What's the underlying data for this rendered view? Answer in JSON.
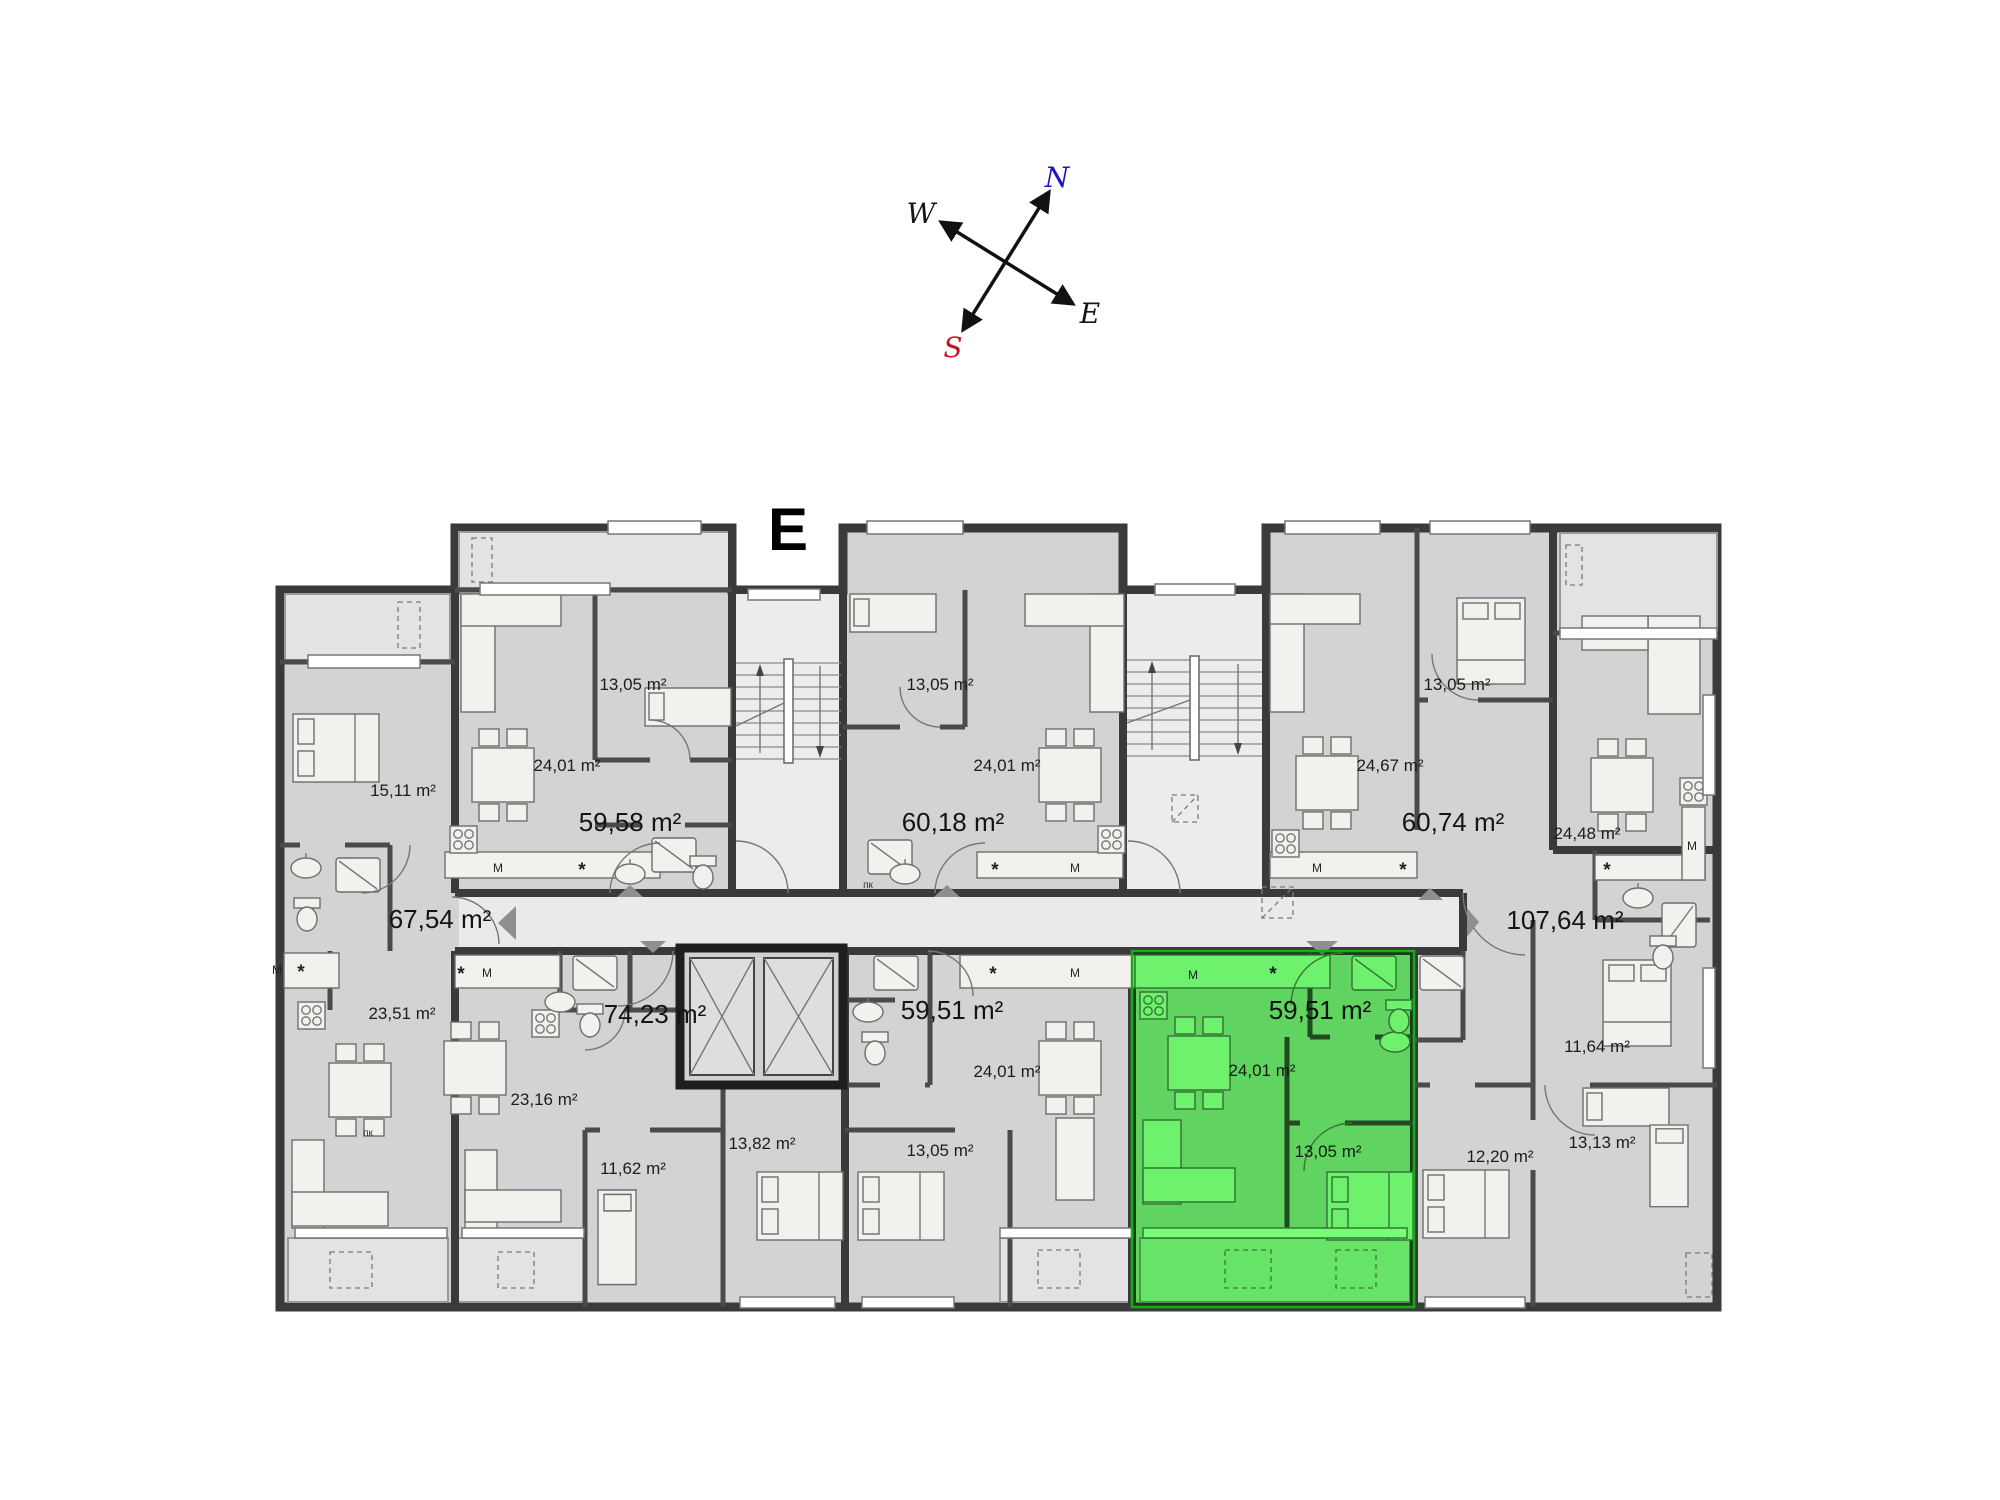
{
  "page": {
    "background": "#ffffff"
  },
  "compass": {
    "arrow_color": "#111111",
    "letters": [
      {
        "text": "N",
        "x": 1057,
        "y": 187,
        "color": "#1a16c4"
      },
      {
        "text": "W",
        "x": 921,
        "y": 223,
        "color": "#161616"
      },
      {
        "text": "E",
        "x": 1090,
        "y": 323,
        "color": "#161616"
      },
      {
        "text": "S",
        "x": 953,
        "y": 357,
        "color": "#c41420"
      }
    ]
  },
  "plan": {
    "block_label": "E",
    "colors": {
      "floor": "#d3d3d3",
      "wall": "#3a3a3a",
      "corridor": "#eaeaea",
      "terrace": "#e3e3e3",
      "furniture": "#f2f1ee",
      "highlight": "#74ff74",
      "highlight_border": "#13ae13",
      "label": "#1c1c1c",
      "triangle": "#8f8f8f"
    },
    "highlight_unit": {
      "label": "59,51 m²",
      "x": 1132,
      "y": 951,
      "width": 282,
      "height": 356
    },
    "area_labels": [
      {
        "text": "13,05 m²",
        "x": 633,
        "y": 690,
        "size": "sm"
      },
      {
        "text": "24,01 m²",
        "x": 567,
        "y": 771,
        "size": "sm"
      },
      {
        "text": "15,11 m²",
        "x": 403,
        "y": 796,
        "size": "sm"
      },
      {
        "text": "59,58 m²",
        "x": 630,
        "y": 831,
        "size": "lg"
      },
      {
        "text": "13,05 m²",
        "x": 940,
        "y": 690,
        "size": "sm"
      },
      {
        "text": "24,01 m²",
        "x": 1007,
        "y": 771,
        "size": "sm"
      },
      {
        "text": "60,18 m²",
        "x": 953,
        "y": 831,
        "size": "lg"
      },
      {
        "text": "13,05 m²",
        "x": 1457,
        "y": 690,
        "size": "sm"
      },
      {
        "text": "24,67 m²",
        "x": 1390,
        "y": 771,
        "size": "sm"
      },
      {
        "text": "60,74 m²",
        "x": 1453,
        "y": 831,
        "size": "lg"
      },
      {
        "text": "24,48 m²",
        "x": 1587,
        "y": 839,
        "size": "sm"
      },
      {
        "text": "67,54 m²",
        "x": 440,
        "y": 928,
        "size": "lg"
      },
      {
        "text": "107,64 m²",
        "x": 1565,
        "y": 929,
        "size": "lg"
      },
      {
        "text": "23,51 m²",
        "x": 402,
        "y": 1019,
        "size": "sm"
      },
      {
        "text": "74,23 m²",
        "x": 655,
        "y": 1023,
        "size": "lg"
      },
      {
        "text": "59,51 m²",
        "x": 952,
        "y": 1019,
        "size": "lg"
      },
      {
        "text": "59,51 m²",
        "x": 1320,
        "y": 1019,
        "size": "lg"
      },
      {
        "text": "23,16 m²",
        "x": 544,
        "y": 1105,
        "size": "sm"
      },
      {
        "text": "24,01 m²",
        "x": 1007,
        "y": 1077,
        "size": "sm"
      },
      {
        "text": "24,01 m²",
        "x": 1262,
        "y": 1076,
        "size": "sm"
      },
      {
        "text": "11,62 m²",
        "x": 633,
        "y": 1174,
        "size": "sm"
      },
      {
        "text": "13,82 m²",
        "x": 762,
        "y": 1149,
        "size": "sm"
      },
      {
        "text": "13,05 m²",
        "x": 940,
        "y": 1156,
        "size": "sm"
      },
      {
        "text": "13,05 m²",
        "x": 1328,
        "y": 1157,
        "size": "sm"
      },
      {
        "text": "12,20 m²",
        "x": 1500,
        "y": 1162,
        "size": "sm"
      },
      {
        "text": "13,13 m²",
        "x": 1602,
        "y": 1148,
        "size": "sm"
      },
      {
        "text": "11,64 m²",
        "x": 1597,
        "y": 1052,
        "size": "sm"
      }
    ],
    "kitchen_marks": [
      {
        "text": "M",
        "x": 498,
        "y": 872,
        "kind": "m"
      },
      {
        "text": "*",
        "x": 582,
        "y": 876,
        "kind": "star"
      },
      {
        "text": "*",
        "x": 995,
        "y": 876,
        "kind": "star"
      },
      {
        "text": "M",
        "x": 1075,
        "y": 872,
        "kind": "m"
      },
      {
        "text": "M",
        "x": 1317,
        "y": 872,
        "kind": "m"
      },
      {
        "text": "*",
        "x": 1403,
        "y": 876,
        "kind": "star"
      },
      {
        "text": "*",
        "x": 1607,
        "y": 876,
        "kind": "star"
      },
      {
        "text": "M",
        "x": 1692,
        "y": 850,
        "kind": "m"
      },
      {
        "text": "M",
        "x": 277,
        "y": 974,
        "kind": "m"
      },
      {
        "text": "*",
        "x": 301,
        "y": 978,
        "kind": "star"
      },
      {
        "text": "*",
        "x": 461,
        "y": 980,
        "kind": "star"
      },
      {
        "text": "M",
        "x": 487,
        "y": 977,
        "kind": "m"
      },
      {
        "text": "*",
        "x": 993,
        "y": 980,
        "kind": "star"
      },
      {
        "text": "M",
        "x": 1075,
        "y": 977,
        "kind": "m"
      },
      {
        "text": "M",
        "x": 1193,
        "y": 979,
        "kind": "m"
      },
      {
        "text": "*",
        "x": 1273,
        "y": 980,
        "kind": "star"
      },
      {
        "text": "пк",
        "x": 868,
        "y": 888,
        "kind": "pk"
      },
      {
        "text": "пк",
        "x": 368,
        "y": 1136,
        "kind": "pk"
      }
    ]
  }
}
